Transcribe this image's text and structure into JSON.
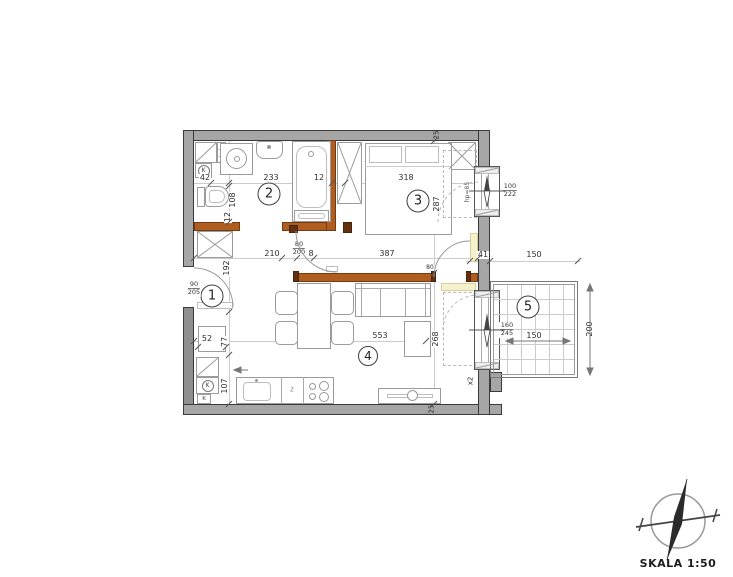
{
  "rooms": [
    "1",
    "2",
    "3",
    "4",
    "5"
  ],
  "labels": {
    "d42": "42",
    "d233": "233",
    "d12_top": "12",
    "d318": "318",
    "d108": "108",
    "d12_side": "12",
    "d192": "192",
    "d52": "52",
    "d77": "77",
    "d107": "107",
    "d210": "210",
    "d8": "8",
    "d387": "387",
    "d41": "41",
    "d150_top": "150",
    "d287": "287",
    "d268": "268",
    "d553": "553",
    "d25_top": "25",
    "d25_bottom": "25",
    "dx2": "x2",
    "d80_door": "80",
    "d150_bal": "150",
    "d200": "200",
    "hp": "hp=85",
    "f90": {
      "w": "90",
      "h": "205"
    },
    "f80": {
      "w": "80",
      "h": "200"
    },
    "f100": {
      "w": "100",
      "h": "222"
    },
    "f160": {
      "w": "160",
      "h": "245"
    },
    "k": "K",
    "z": "z"
  },
  "scale": {
    "label": "SKALA 1:50"
  },
  "colors": {
    "wall": "#a6a6a6",
    "partition": "#b05d20",
    "radiator": "#f6f1cd"
  }
}
